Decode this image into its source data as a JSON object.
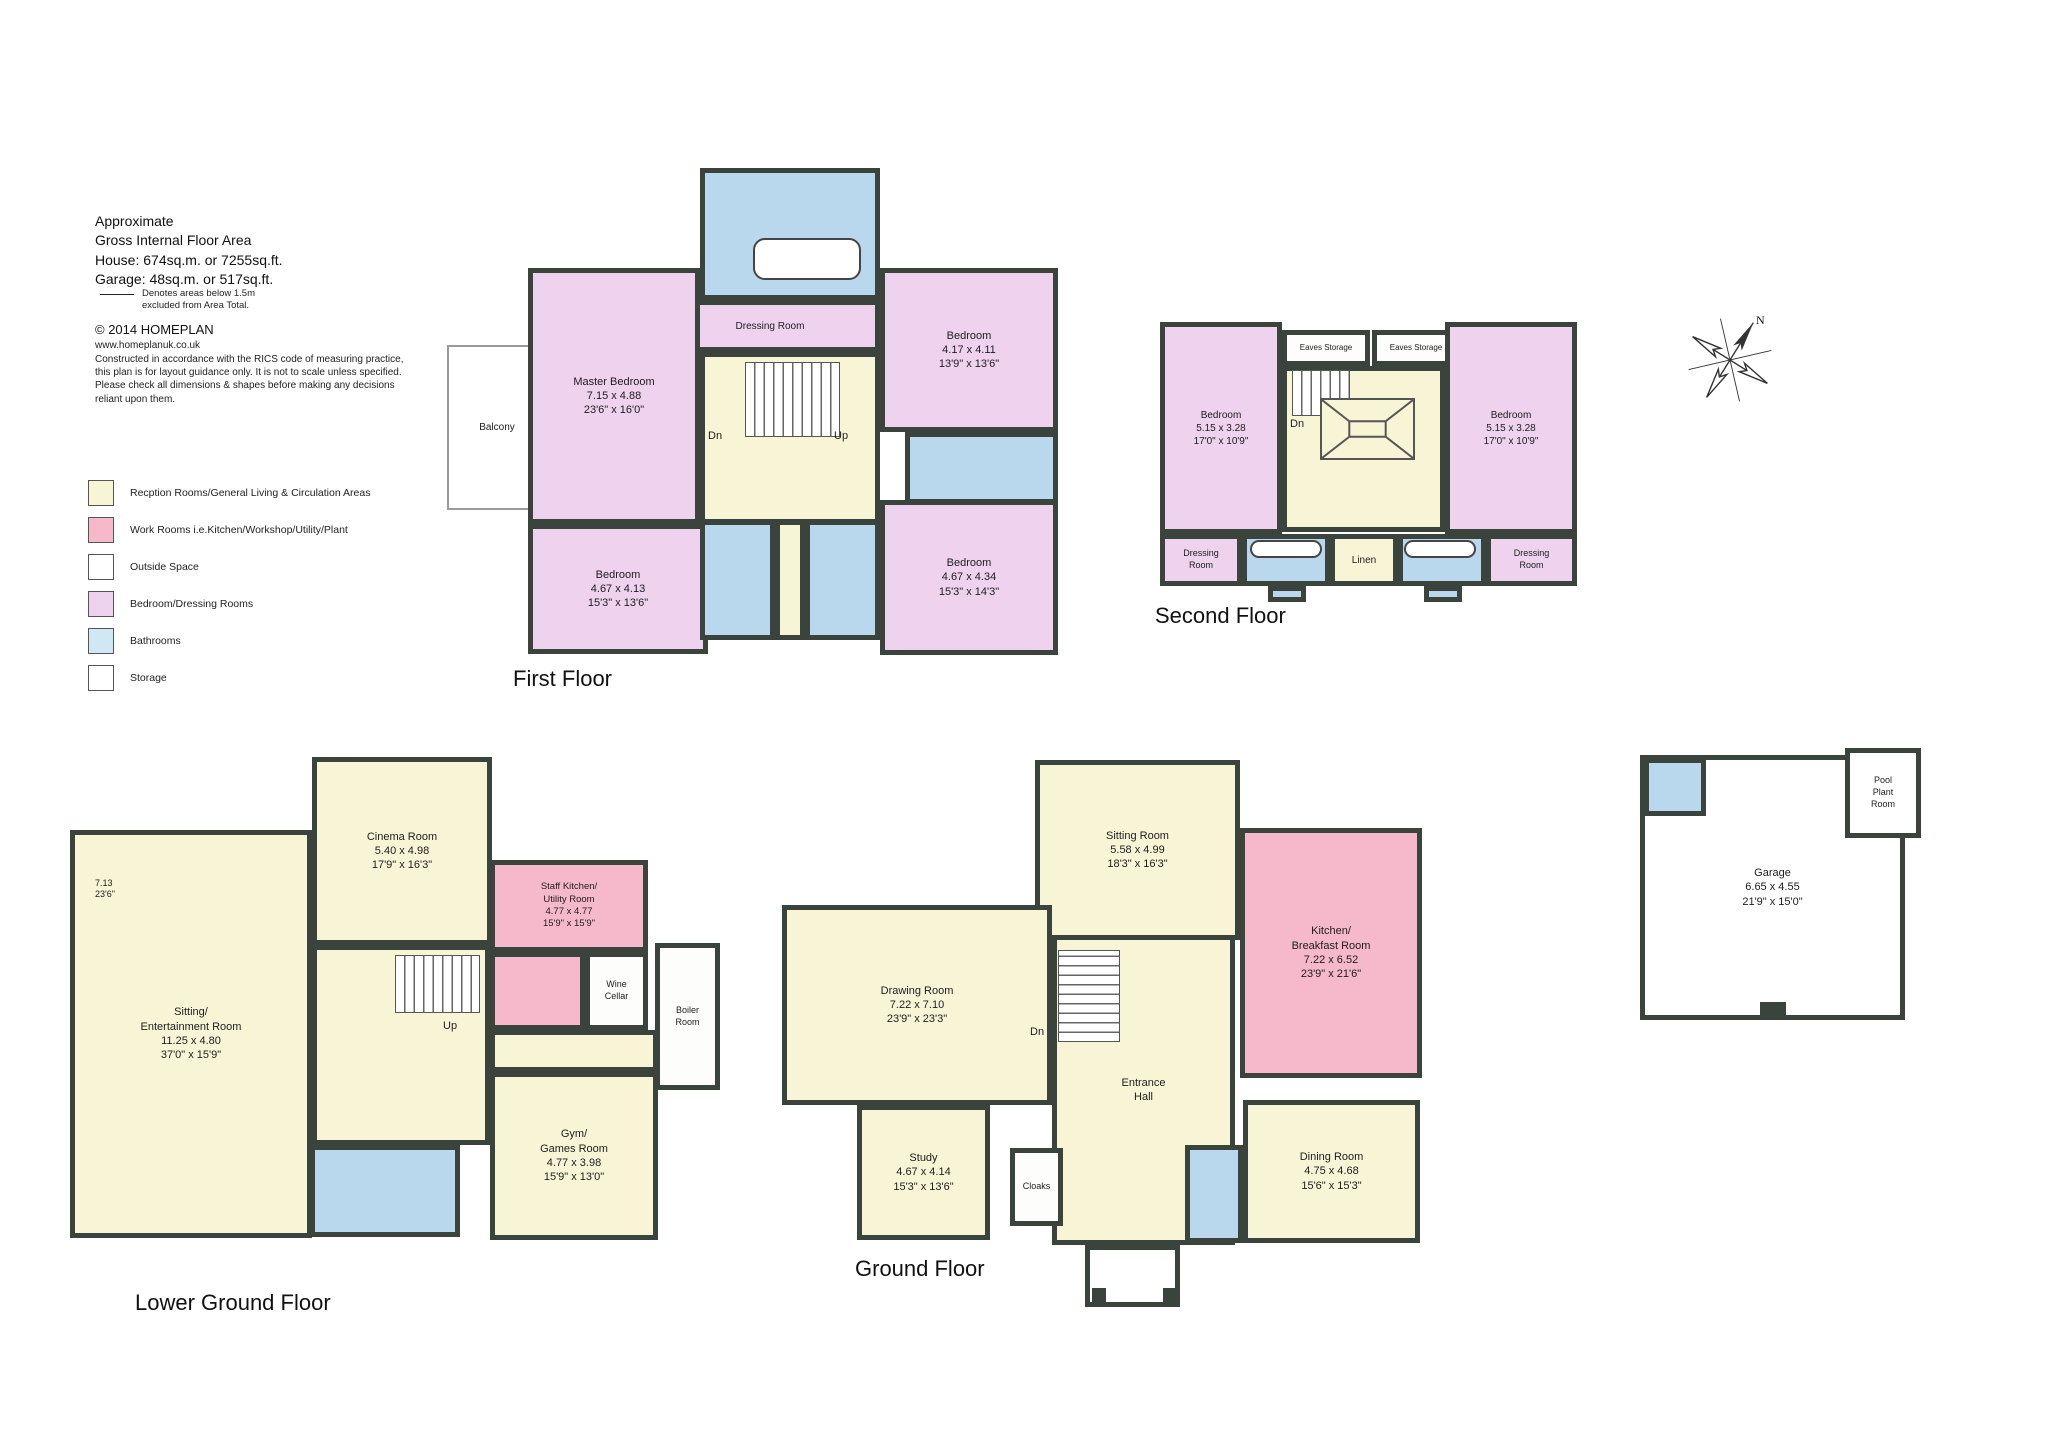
{
  "header": {
    "line1": "Approximate",
    "line2": "Gross Internal Floor Area",
    "line3": "House: 674sq.m. or 7255sq.ft.",
    "line4": "Garage: 48sq.m. or 517sq.ft.",
    "note": "Denotes areas below 1.5m\nexcluded from Area Total.",
    "copyright": "© 2014 HOMEPLAN",
    "website": "www.homeplanuk.co.uk",
    "disclaimer": "Constructed in accordance with the RICS code of measuring practice, this plan is for layout guidance only. It is not to scale unless specified.  Please check all dimensions & shapes before making any decisions reliant upon them."
  },
  "legend": {
    "items": [
      {
        "label": "Recption Rooms/General Living & Circulation Areas",
        "color": "#f8f5d6"
      },
      {
        "label": "Work Rooms i.e.Kitchen/Workshop/Utility/Plant",
        "color": "#f6b8cb"
      },
      {
        "label": "Outside Space",
        "color": "#ffffff"
      },
      {
        "label": "Bedroom/Dressing Rooms",
        "color": "#eed2ee"
      },
      {
        "label": "Bathrooms",
        "color": "#cfe8f4"
      },
      {
        "label": "Storage",
        "color": "#ffffff"
      }
    ]
  },
  "compass": {
    "north_label": "N"
  },
  "floors": [
    {
      "id": "first-floor",
      "title": "First Floor",
      "title_pos": [
        513,
        666
      ],
      "rooms": [
        {
          "id": "balcony",
          "type": "outside",
          "rect": [
            447,
            345,
            100,
            165
          ],
          "label": [
            "Balcony"
          ],
          "fs": 10
        },
        {
          "id": "master-bathroom",
          "type": "bathroom",
          "rect": [
            700,
            168,
            180,
            132
          ]
        },
        {
          "id": "dressing-room",
          "type": "bedroom",
          "rect": [
            660,
            300,
            220,
            52
          ],
          "label": [
            "Dressing Room"
          ],
          "fs": 10
        },
        {
          "id": "master-bedroom",
          "type": "bedroom",
          "rect": [
            528,
            268,
            172,
            256
          ],
          "label": [
            "Master Bedroom",
            "7.15 x 4.88",
            "23'6\" x 16'0\""
          ]
        },
        {
          "id": "landing",
          "type": "reception",
          "rect": [
            700,
            352,
            180,
            172
          ]
        },
        {
          "id": "bedroom-ne",
          "type": "bedroom",
          "rect": [
            880,
            268,
            178,
            164
          ],
          "label": [
            "Bedroom",
            "4.17 x 4.11",
            "13'9\" x 13'6\""
          ]
        },
        {
          "id": "ensuite-ne",
          "type": "bathroom",
          "rect": [
            905,
            432,
            153,
            72
          ]
        },
        {
          "id": "bedroom-sw",
          "type": "bedroom",
          "rect": [
            528,
            524,
            180,
            130
          ],
          "label": [
            "Bedroom",
            "4.67 x 4.13",
            "15'3\" x 13'6\""
          ]
        },
        {
          "id": "shower-room-a",
          "type": "bathroom",
          "rect": [
            700,
            520,
            75,
            120
          ]
        },
        {
          "id": "landing-south",
          "type": "reception",
          "rect": [
            775,
            520,
            30,
            120
          ]
        },
        {
          "id": "shower-room-b",
          "type": "bathroom",
          "rect": [
            805,
            520,
            75,
            120
          ]
        },
        {
          "id": "bedroom-se",
          "type": "bedroom",
          "rect": [
            880,
            500,
            178,
            155
          ],
          "label": [
            "Bedroom",
            "4.67 x 4.34",
            "15'3\" x 14'3\""
          ]
        }
      ],
      "features": [
        {
          "kind": "outline",
          "rect": [
            753,
            238,
            108,
            42
          ]
        },
        {
          "kind": "stairs",
          "rect": [
            745,
            362,
            95,
            75
          ]
        },
        {
          "kind": "label",
          "pos": [
            708,
            430
          ],
          "text": "Dn",
          "fs": 11
        },
        {
          "kind": "label",
          "pos": [
            834,
            430
          ],
          "text": "Up",
          "fs": 11
        }
      ]
    },
    {
      "id": "second-floor",
      "title": "Second Floor",
      "title_pos": [
        1155,
        603
      ],
      "rooms": [
        {
          "id": "bedroom-left",
          "type": "bedroom",
          "rect": [
            1160,
            322,
            122,
            212
          ],
          "label": [
            "Bedroom",
            "5.15 x 3.28",
            "17'0\" x 10'9\""
          ],
          "fs": 10
        },
        {
          "id": "eaves-storage-left",
          "type": "storage",
          "rect": [
            1282,
            330,
            88,
            36
          ],
          "label": [
            "Eaves Storage"
          ],
          "fs": 8
        },
        {
          "id": "eaves-storage-right",
          "type": "storage",
          "rect": [
            1372,
            330,
            88,
            36
          ],
          "label": [
            "Eaves Storage"
          ],
          "fs": 8
        },
        {
          "id": "stair-core",
          "type": "reception",
          "rect": [
            1282,
            366,
            163,
            166
          ]
        },
        {
          "id": "bedroom-right",
          "type": "bedroom",
          "rect": [
            1445,
            322,
            132,
            212
          ],
          "label": [
            "Bedroom",
            "5.15 x 3.28",
            "17'0\" x 10'9\""
          ],
          "fs": 10
        },
        {
          "id": "dressing-room-left",
          "type": "bedroom",
          "rect": [
            1160,
            534,
            82,
            52
          ],
          "label": [
            "Dressing\nRoom"
          ],
          "fs": 9
        },
        {
          "id": "bathroom-left",
          "type": "bathroom",
          "rect": [
            1242,
            534,
            88,
            52
          ]
        },
        {
          "id": "linen",
          "type": "reception",
          "rect": [
            1330,
            534,
            68,
            52
          ],
          "label": [
            "Linen"
          ],
          "fs": 10
        },
        {
          "id": "bathroom-right",
          "type": "bathroom",
          "rect": [
            1398,
            534,
            88,
            52
          ]
        },
        {
          "id": "dressing-room-right",
          "type": "bedroom",
          "rect": [
            1486,
            534,
            91,
            52
          ],
          "label": [
            "Dressing\nRoom"
          ],
          "fs": 9
        },
        {
          "id": "bath-tab-left",
          "type": "bathroom",
          "rect": [
            1268,
            586,
            38,
            16
          ]
        },
        {
          "id": "bath-tab-right",
          "type": "bathroom",
          "rect": [
            1424,
            586,
            38,
            16
          ]
        }
      ],
      "features": [
        {
          "kind": "stairs",
          "rect": [
            1292,
            370,
            58,
            46
          ]
        },
        {
          "kind": "lantern",
          "rect": [
            1320,
            398,
            95,
            62
          ]
        },
        {
          "kind": "label",
          "pos": [
            1290,
            418
          ],
          "text": "Dn",
          "fs": 11
        },
        {
          "kind": "outline",
          "rect": [
            1250,
            540,
            72,
            18
          ]
        },
        {
          "kind": "outline",
          "rect": [
            1404,
            540,
            72,
            18
          ]
        }
      ]
    },
    {
      "id": "lower-ground-floor",
      "title": "Lower Ground Floor",
      "title_pos": [
        135,
        1290
      ],
      "rooms": [
        {
          "id": "sitting-entertainment-room",
          "type": "reception",
          "rect": [
            70,
            830,
            242,
            408
          ],
          "label": [
            "Sitting/",
            "Entertainment Room",
            "11.25 x 4.80",
            "37'0\" x 15'9\""
          ]
        },
        {
          "id": "cinema-room",
          "type": "reception",
          "rect": [
            312,
            757,
            180,
            188
          ],
          "label": [
            "Cinema Room",
            "5.40 x 4.98",
            "17'9\" x 16'3\""
          ]
        },
        {
          "id": "lgf-hall",
          "type": "reception",
          "rect": [
            312,
            945,
            178,
            200
          ]
        },
        {
          "id": "staff-kitchen-utility",
          "type": "work",
          "rect": [
            490,
            860,
            158,
            92
          ],
          "label": [
            "Staff Kitchen/",
            "Utility Room",
            "4.77 x 4.77",
            "15'9\" x 15'9\""
          ],
          "fs": 9.5
        },
        {
          "id": "utility-lower",
          "type": "work",
          "rect": [
            490,
            952,
            95,
            78
          ]
        },
        {
          "id": "wine-cellar",
          "type": "storage",
          "rect": [
            585,
            952,
            63,
            78
          ],
          "label": [
            "Wine\nCellar"
          ],
          "fs": 9
        },
        {
          "id": "boiler-room",
          "type": "storage",
          "rect": [
            655,
            943,
            65,
            147
          ],
          "label": [
            "Boiler\nRoom"
          ],
          "fs": 9
        },
        {
          "id": "lgf-hall-2",
          "type": "reception",
          "rect": [
            490,
            1030,
            168,
            42
          ]
        },
        {
          "id": "gym-games-room",
          "type": "reception",
          "rect": [
            490,
            1072,
            168,
            168
          ],
          "label": [
            "Gym/",
            "Games Room",
            "4.77 x 3.98",
            "15'9\" x 13'0\""
          ]
        },
        {
          "id": "lgf-bathroom",
          "type": "bathroom",
          "rect": [
            310,
            1145,
            150,
            92
          ]
        }
      ],
      "features": [
        {
          "kind": "stairs",
          "rect": [
            395,
            955,
            85,
            58
          ]
        },
        {
          "kind": "label",
          "pos": [
            443,
            1020
          ],
          "text": "Up",
          "fs": 11
        },
        {
          "kind": "label",
          "pos": [
            95,
            878
          ],
          "text": "7.13\n23'6\"",
          "fs": 9
        }
      ]
    },
    {
      "id": "ground-floor",
      "title": "Ground Floor",
      "title_pos": [
        855,
        1256
      ],
      "rooms": [
        {
          "id": "sitting-room",
          "type": "reception",
          "rect": [
            1035,
            760,
            205,
            180
          ],
          "label": [
            "Sitting Room",
            "5.58 x 4.99",
            "18'3\" x 16'3\""
          ]
        },
        {
          "id": "kitchen-breakfast-room",
          "type": "work",
          "rect": [
            1240,
            828,
            182,
            250
          ],
          "label": [
            "Kitchen/",
            "Breakfast Room",
            "7.22 x 6.52",
            "23'9\" x 21'6\""
          ]
        },
        {
          "id": "drawing-room",
          "type": "reception",
          "rect": [
            782,
            905,
            270,
            200
          ],
          "label": [
            "Drawing Room",
            "7.22 x 7.10",
            "23'9\" x 23'3\""
          ]
        },
        {
          "id": "entrance-hall",
          "type": "reception",
          "rect": [
            1052,
            935,
            183,
            310
          ],
          "label": [
            "Entrance",
            "Hall"
          ]
        },
        {
          "id": "study",
          "type": "reception",
          "rect": [
            857,
            1105,
            133,
            135
          ],
          "label": [
            "Study",
            "4.67 x 4.14",
            "15'3\" x 13'6\""
          ]
        },
        {
          "id": "cloaks",
          "type": "storage",
          "rect": [
            1010,
            1148,
            53,
            78
          ],
          "label": [
            "Cloaks"
          ],
          "fs": 9
        },
        {
          "id": "gf-wc",
          "type": "bathroom",
          "rect": [
            1185,
            1145,
            58,
            98
          ]
        },
        {
          "id": "dining-room",
          "type": "reception",
          "rect": [
            1243,
            1100,
            177,
            143
          ],
          "label": [
            "Dining Room",
            "4.75 x 4.68",
            "15'6\" x 15'3\""
          ]
        },
        {
          "id": "porch",
          "type": "plain",
          "rect": [
            1085,
            1245,
            95,
            62
          ]
        }
      ],
      "features": [
        {
          "kind": "stairs",
          "rect": [
            1058,
            950,
            62,
            92
          ]
        },
        {
          "kind": "label",
          "pos": [
            1030,
            1026
          ],
          "text": "Dn",
          "fs": 11
        },
        {
          "kind": "block",
          "rect": [
            1092,
            1288,
            14,
            14
          ]
        },
        {
          "kind": "block",
          "rect": [
            1163,
            1288,
            14,
            14
          ]
        }
      ]
    },
    {
      "id": "garage-block",
      "title": null,
      "rooms": [
        {
          "id": "garage",
          "type": "plain",
          "rect": [
            1640,
            755,
            265,
            265
          ],
          "label": [
            "Garage",
            "6.65 x 4.55",
            "21'9\" x 15'0\""
          ]
        },
        {
          "id": "pool-plant-room",
          "type": "plain",
          "rect": [
            1845,
            748,
            76,
            90
          ],
          "label": [
            "Pool\nPlant\nRoom"
          ],
          "fs": 9
        },
        {
          "id": "garage-bathroom",
          "type": "bathroom",
          "rect": [
            1644,
            758,
            62,
            58
          ]
        }
      ],
      "features": [
        {
          "kind": "block",
          "rect": [
            1760,
            1002,
            26,
            14
          ]
        }
      ]
    }
  ]
}
